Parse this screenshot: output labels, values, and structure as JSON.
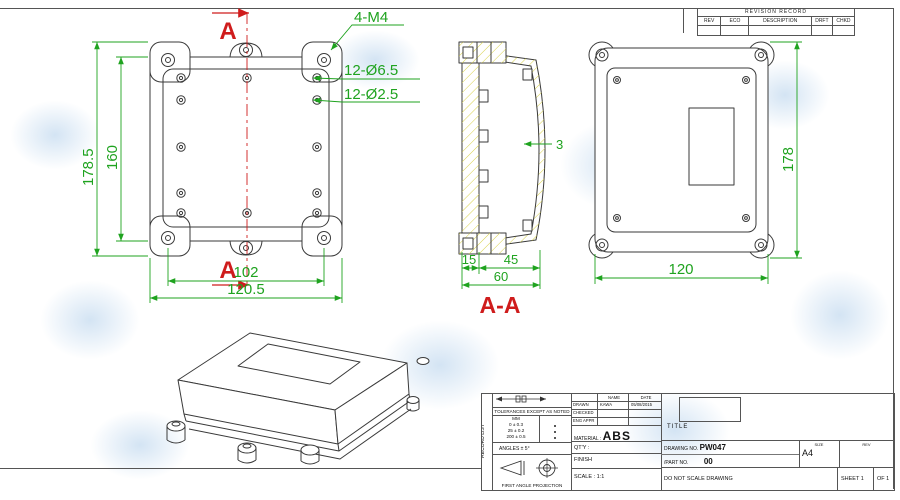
{
  "colors": {
    "line": "#3a3a3a",
    "dimension_green": "#1fa31f",
    "section_red": "#cf1c1c",
    "hatch_yellow": "#d8d24a",
    "watermark_blue": "#a8c9e8"
  },
  "revision_table": {
    "title": "REVISION RECORD",
    "columns": [
      "REV",
      "ECO",
      "DESCRIPTION",
      "DRFT",
      "CHKD"
    ]
  },
  "front_view": {
    "section_marker": "A",
    "thread_label": "4-M4",
    "hole_outer_label": "12-Ø6.5",
    "hole_inner_label": "12-Ø2.5",
    "dim_height_outer": "178.5",
    "dim_height_inner": "160",
    "dim_width_inner": "102",
    "dim_width_outer": "120.5"
  },
  "section_view": {
    "label": "A-A",
    "dim_base": "15",
    "dim_lid": "45",
    "dim_total": "60",
    "dim_wall": "3"
  },
  "back_view": {
    "dim_height": "178",
    "dim_width": "120"
  },
  "title_block": {
    "record_list": "RECORD LIST",
    "tolerances_title": "TOLERANCES EXCEPT AS NOTED",
    "mm": "MM",
    "tol_rows": [
      "0 ± 0.3",
      "25 ± 0.2",
      "200 ± 0.5"
    ],
    "angles": "ANGLES ± 5°",
    "projection": "FIRST ANGLE PROJECTION",
    "name_h": "NAME",
    "date_h": "DATE",
    "drawn": "DRAWN",
    "drawn_name": "KAWA",
    "drawn_date": "05/08/2015",
    "checked": "CHECKED",
    "eng_appr": "ENG APPR",
    "material_label": "MATERIAL :",
    "material": "ABS",
    "qty": "QT'Y :",
    "finish": "FINISH",
    "scale": "SCALE : 1:1",
    "title": "TITLE",
    "drawing_no_label": "DRAWING NO.",
    "drawing_no": "PW047",
    "part_no_label": "/PART NO.",
    "part_no": "00",
    "size_label": "SIZE",
    "size": "A4",
    "rev": "REV",
    "do_not_scale": "DO NOT SCALE DRAWING",
    "sheet": "SHEET 1",
    "of": "OF 1"
  }
}
